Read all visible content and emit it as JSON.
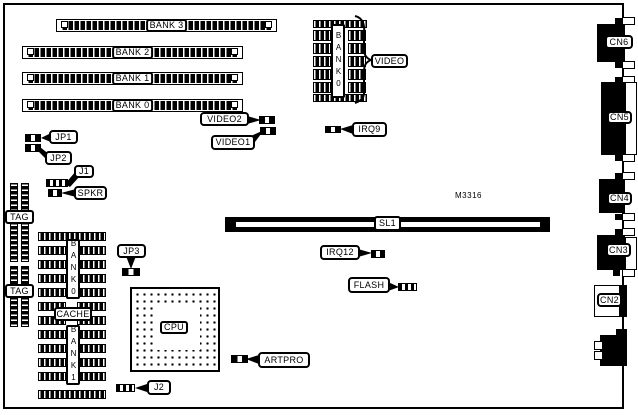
{
  "part_number": "M3316",
  "memory_slots": [
    {
      "label": "BANK 3"
    },
    {
      "label": "BANK 2"
    },
    {
      "label": "BANK 1"
    },
    {
      "label": "BANK 0"
    }
  ],
  "video_module": {
    "vertical_label": "BANK0",
    "callout": "VIDEO"
  },
  "cache_module": {
    "top_bank": "BANK0",
    "center": "CACHE",
    "bottom_bank": "BANK1"
  },
  "tag_chips": [
    {
      "label": "TAG"
    },
    {
      "label": "TAG"
    }
  ],
  "cpu": {
    "label": "CPU"
  },
  "expansion_slot": {
    "label": "SL1"
  },
  "callouts": {
    "jp1": "JP1",
    "jp2": "JP2",
    "j1": "J1",
    "spkr": "SPKR",
    "jp3": "JP3",
    "j2": "J2",
    "video2": "VIDEO2",
    "video1": "VIDEO1",
    "irq9": "IRQ9",
    "irq12": "IRQ12",
    "flash": "FLASH",
    "artpro": "ARTPRO"
  },
  "connectors": [
    {
      "label": "CN6"
    },
    {
      "label": "CN5"
    },
    {
      "label": "CN4"
    },
    {
      "label": "CN3"
    },
    {
      "label": "CN2"
    }
  ],
  "colors": {
    "ink": "#000000",
    "background": "#ffffff"
  }
}
